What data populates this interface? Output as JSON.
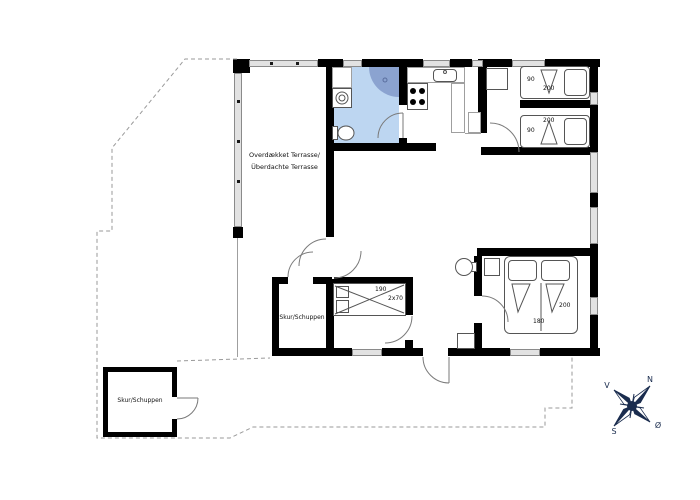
{
  "terrace": {
    "label_line1": "Overdækket Terrasse/",
    "label_line2": "Überdachte Terrasse"
  },
  "sheds": {
    "attached_label": "Skur/Schuppen",
    "detached_label": "Skur/Schuppen"
  },
  "bedroom1": {
    "bed_width_cm": "90",
    "bed_length_cm": "200"
  },
  "bedroom2": {
    "bed_length_cm": "200",
    "bed_width_cm": "90"
  },
  "bunk_room": {
    "bed_length_cm": "190",
    "bed_size": "2x70"
  },
  "bedroom3": {
    "bed_length_cm": "200",
    "bed_width_cm": "180"
  },
  "compass": {
    "north": "N",
    "south": "S",
    "west": "V",
    "east": "Ø"
  },
  "colors": {
    "wall": "#000000",
    "window_fill": "#e2e2e2",
    "bathroom_fill": "#bdd6f1",
    "shower_fill": "#8ba3d0",
    "boundary": "#9a9a9a",
    "compass": "#1a2c4e",
    "door_arc": "#7a7a7a"
  }
}
